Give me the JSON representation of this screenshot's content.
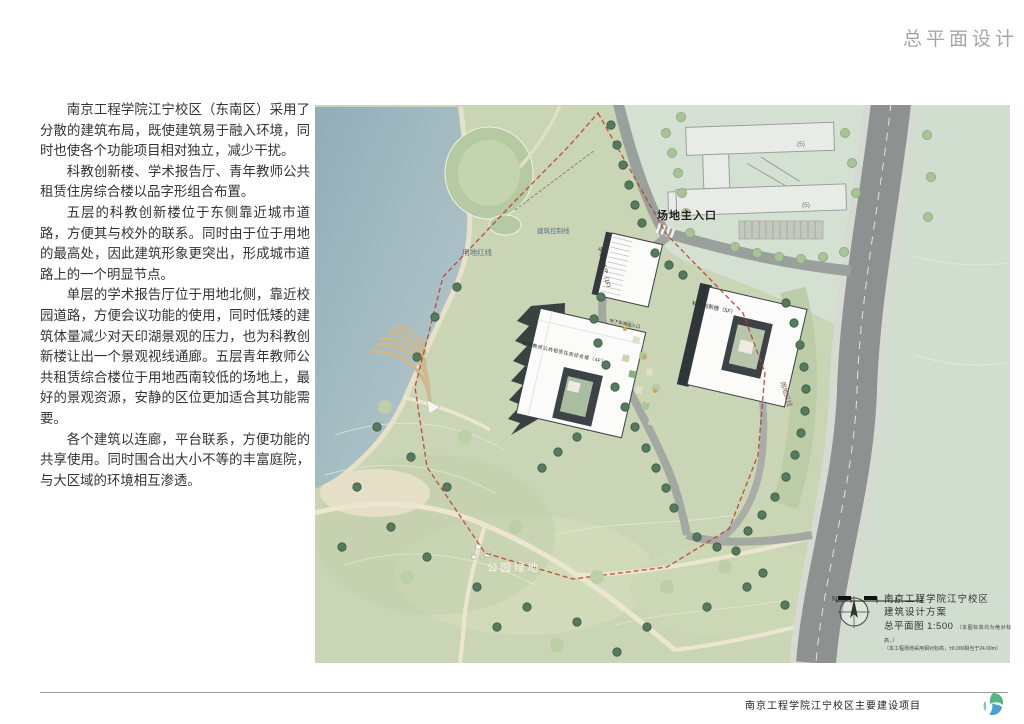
{
  "page": {
    "title": "总平面设计",
    "footer_project": "南京工程学院江宁校区主要建设项目"
  },
  "description": {
    "p1": "南京工程学院江宁校区（东南区）采用了分散的建筑布局，既使建筑易于融入环境，同时也使各个功能项目相对独立，减少干扰。",
    "p2": "科教创新楼、学术报告厅、青年教师公共租赁住房综合楼以品字形组合布置。",
    "p3": "五层的科教创新楼位于东侧靠近城市道路，方便其与校外的联系。同时由于位于用地的最高处，因此建筑形象更突出，形成城市道路上的一个明显节点。",
    "p4": "单层的学术报告厅位于用地北侧，靠近校园道路，方便会议功能的使用，同时低矮的建筑体量减少对天印湖景观的压力，也为科教创新楼让出一个景观视线通廊。五层青年教师公共租赁综合楼位于用地西南较低的场地上，最好的景观资源，安静的区位更加适合其功能需要。",
    "p5": "各个建筑以连廊，平台联系，方便功能的共享使用。同时围合出大小不等的丰富庭院，与大区域的环境相互渗透。"
  },
  "plan": {
    "labels": {
      "main_entrance": "场地主入口",
      "red_line": "用地红线",
      "red_line2": "用地红线",
      "control_line": "建筑控制线",
      "park_green": "公园绿地",
      "academic_hall": "学术报告厅（1F）",
      "science_building": "科教创新楼（5F）",
      "teacher_housing": "青年教师公共租赁住房综合楼（4F）",
      "garage_entry": "地下车库出入口",
      "existing_floors_a": "(5)",
      "existing_floors_b": "(5)"
    },
    "colors": {
      "boundary_red": "#c23b2e",
      "lake": "#a7bec7",
      "park": "#cad5b5",
      "road": "#8d9290"
    }
  },
  "stats_table": {
    "title": "主要经济技术指标",
    "site_area_label": "总用地面积",
    "site_area_value": "38072.39㎡",
    "gfa_label": "总建筑面积",
    "gfa_value": "31342.4㎡",
    "among": "其中",
    "gfa_above": "地上：25238.83㎡",
    "gfa_below": "地下：6131.57㎡",
    "col_building": "建筑栋号",
    "col_area": "建筑面积",
    "col_above": "地上",
    "col_below": "地下",
    "col_counted": "计容面积",
    "group_label": "分栋",
    "buildings": [
      {
        "name": "学术报告厅",
        "total": "3255.76㎡",
        "above": "3255.76㎡",
        "below": "0",
        "counted": "3255.76㎡"
      },
      {
        "name": "科教创新楼",
        "total": "13359.17㎡",
        "above": "11704.37㎡",
        "below": "1654.8㎡",
        "counted": "11704.37㎡"
      },
      {
        "name": "青年教师公共租赁住房综合楼",
        "total": "9927.18㎡",
        "above": "9927.18㎡",
        "below": "0",
        "counted": "14880.78㎡"
      },
      {
        "name": "展列室",
        "total": "5520.28㎡",
        "above": "1242.51㎡",
        "below": "4476.77㎡",
        "counted": "1242.51㎡"
      }
    ],
    "metrics": [
      {
        "label": "总占地面积",
        "value": "8797.32㎡"
      },
      {
        "label": "容积率",
        "value": "0.793"
      },
      {
        "label": "建筑密度",
        "value": "23.1%"
      },
      {
        "label": "绿地面积",
        "value": "14970.02㎡"
      },
      {
        "label": "绿地率",
        "value": "39.32%"
      }
    ],
    "parking": {
      "total_label": "总停车位",
      "total_value": "665",
      "among": "其中",
      "group_nonmotor": "非机动车",
      "group_motor": "机动车",
      "above_label": "地上",
      "below_label": "地下",
      "nonmotor_above": "505",
      "nonmotor_below": "0",
      "motor_above": "40",
      "motor_below": "120",
      "col_demand": "配建需求",
      "col_design": "设计",
      "col_supplement": "校内补充",
      "rows": [
        {
          "name": "科教创新楼",
          "v0": "308",
          "v1": "280",
          "v2": "280",
          "v3": "80",
          "v4": "128"
        },
        {
          "name": "学术报告厅",
          "v0": "34",
          "v1": "34",
          "v2": "34",
          "v3": "34",
          "v4": "8"
        },
        {
          "name": "青年教师公共租赁住房综合楼",
          "v0": "248",
          "v1": "248",
          "v2": "48",
          "v3": "20",
          "v4": "14"
        },
        {
          "name": "展列室",
          "v0": "30",
          "v1": "23",
          "v2": "26",
          "v3": "20",
          "v4": "8"
        },
        {
          "name": "合计",
          "v0": "562",
          "v1": "585",
          "v2": "294",
          "v3": "140",
          "v4": "134"
        }
      ]
    },
    "height_label": "建筑限高",
    "height_value": "18m",
    "note1": "3、停车数量按《南京市建筑物配建停车设施设置标准与准则（2010年修订）》计算。其中，",
    "note2": "科教创新楼、学术报告厅、青年教师公共租赁综合楼停车位按规范配建指标设置，",
    "note3": "青年教师数量按公寓成套数计算指标为1/4，停车位按计算取整数。"
  },
  "title_block": {
    "north": "N",
    "line1": "南京工程学院江宁校区",
    "line2": "建筑设计方案",
    "line3": "总平面图 1:500",
    "line3_note": "（本图标高均为绝对标高。）",
    "line4": "（本工程场地采用相对标高，±0.000相当于24.00m）"
  }
}
